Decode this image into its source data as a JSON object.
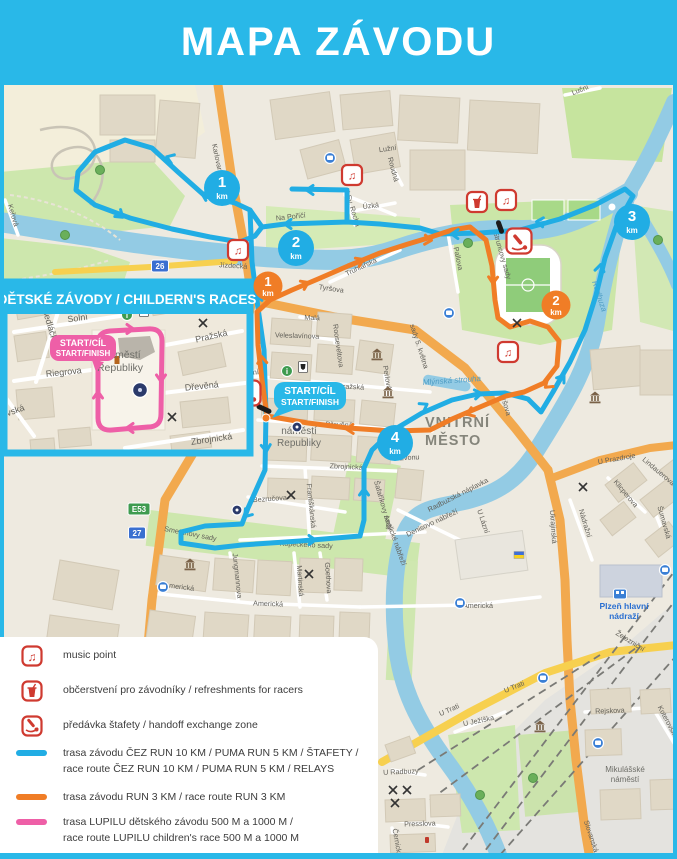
{
  "header": {
    "title": "MAPA ZÁVODU"
  },
  "colors": {
    "brand_cyan": "#29b8e8",
    "route_cyan": "#21ade4",
    "route_orange": "#f07d26",
    "route_pink": "#ee5fa7",
    "icon_red": "#cf3a30",
    "water": "#93cbe4",
    "park": "#cde7ad"
  },
  "inset": {
    "title": "DĚTSKÉ ZÁVODY / CHILDERN'S RACES",
    "start_badge": [
      "START/CÍL",
      "START/FINISH"
    ],
    "square_label": [
      "náměstí",
      "Republiky"
    ],
    "street_labels": [
      {
        "t": "Solní",
        "x": 78,
        "y": 321,
        "r": -8
      },
      {
        "t": "Pražská",
        "x": 212,
        "y": 339,
        "r": -13
      },
      {
        "t": "Sedláčkova",
        "x": 49,
        "y": 332,
        "r": 73
      },
      {
        "t": "Riegrova",
        "x": 64,
        "y": 375,
        "r": -6
      },
      {
        "t": "Dřevěná",
        "x": 202,
        "y": 389,
        "r": -6
      },
      {
        "t": "Zbrojnická",
        "x": 212,
        "y": 442,
        "r": -8
      },
      {
        "t": "ovská",
        "x": 14,
        "y": 414,
        "r": -20
      }
    ],
    "pois": [
      {
        "type": "info",
        "x": 127,
        "y": 315
      },
      {
        "type": "museum-flag",
        "x": 144,
        "y": 311
      },
      {
        "type": "monument-lg",
        "x": 140,
        "y": 390
      },
      {
        "type": "church-cross",
        "x": 203,
        "y": 323
      },
      {
        "type": "church-cross",
        "x": 172,
        "y": 417
      },
      {
        "type": "tower",
        "x": 117,
        "y": 360
      }
    ]
  },
  "map": {
    "start_badge": [
      "START/CÍL",
      "START/FINISH"
    ],
    "km_badges": [
      {
        "value": "1",
        "unit": "km",
        "variant": "cyan",
        "x": 222,
        "y": 188
      },
      {
        "value": "2",
        "unit": "km",
        "variant": "cyan",
        "x": 296,
        "y": 248
      },
      {
        "value": "3",
        "unit": "km",
        "variant": "cyan",
        "x": 632,
        "y": 222
      },
      {
        "value": "4",
        "unit": "km",
        "variant": "cyan",
        "x": 395,
        "y": 443
      },
      {
        "value": "1",
        "unit": "km",
        "variant": "orange",
        "x": 268,
        "y": 286
      },
      {
        "value": "2",
        "unit": "km",
        "variant": "orange",
        "x": 556,
        "y": 305
      }
    ],
    "road_badges": [
      {
        "t": "26",
        "x": 160,
        "y": 266,
        "variant": "blue"
      },
      {
        "t": "27",
        "x": 137,
        "y": 533,
        "variant": "blue"
      },
      {
        "t": "E53",
        "x": 139,
        "y": 509,
        "variant": "green"
      }
    ],
    "street_labels": [
      {
        "t": "Karlovarská",
        "x": 216,
        "y": 163,
        "r": 78
      },
      {
        "t": "Jízdecká",
        "x": 233,
        "y": 268,
        "r": 3
      },
      {
        "t": "Na Poříčí",
        "x": 291,
        "y": 219,
        "r": -6
      },
      {
        "t": "Tyršova",
        "x": 331,
        "y": 291,
        "r": 8
      },
      {
        "t": "Tyršova",
        "x": 503,
        "y": 404,
        "r": 73
      },
      {
        "t": "sady 5. května",
        "x": 417,
        "y": 347,
        "r": 72
      },
      {
        "t": "Rooseveltova",
        "x": 336,
        "y": 346,
        "r": 82
      },
      {
        "t": "Pražská",
        "x": 351,
        "y": 389,
        "r": 3
      },
      {
        "t": "Dřevěná",
        "x": 339,
        "y": 427,
        "r": 2
      },
      {
        "t": "Zbrojnická",
        "x": 346,
        "y": 469,
        "r": 3
      },
      {
        "t": "Bezručova",
        "x": 270,
        "y": 501,
        "r": -4
      },
      {
        "t": "Františkánská",
        "x": 309,
        "y": 506,
        "r": 84
      },
      {
        "t": "Smetanovy sady",
        "x": 190,
        "y": 536,
        "r": 11
      },
      {
        "t": "Kopeckého sady",
        "x": 306,
        "y": 547,
        "r": 3
      },
      {
        "t": "Americká",
        "x": 179,
        "y": 589,
        "r": 7
      },
      {
        "t": "Americká",
        "x": 268,
        "y": 606,
        "r": 2
      },
      {
        "t": "Americká",
        "x": 478,
        "y": 608,
        "r": 0
      },
      {
        "t": "Jungmannova",
        "x": 235,
        "y": 576,
        "r": 84
      },
      {
        "t": "Martinská",
        "x": 298,
        "y": 581,
        "r": 86
      },
      {
        "t": "Goethova",
        "x": 326,
        "y": 578,
        "r": 86
      },
      {
        "t": "Šafaříkovy sady",
        "x": 381,
        "y": 506,
        "r": 74
      },
      {
        "t": "Anglické nábřeží",
        "x": 393,
        "y": 541,
        "r": 70
      },
      {
        "t": "Pallova",
        "x": 456,
        "y": 259,
        "r": 78
      },
      {
        "t": "Štruncovy sady",
        "x": 500,
        "y": 256,
        "r": 74
      },
      {
        "t": "U Zvonu",
        "x": 406,
        "y": 460,
        "r": -3
      },
      {
        "t": "Denisovo nábřeží",
        "x": 433,
        "y": 525,
        "r": -25
      },
      {
        "t": "Radbuzská náplavka",
        "x": 459,
        "y": 497,
        "r": -27
      },
      {
        "t": "U Lázní",
        "x": 481,
        "y": 522,
        "r": 72
      },
      {
        "t": "Ukrajinská",
        "x": 551,
        "y": 527,
        "r": 86
      },
      {
        "t": "Nádražní",
        "x": 583,
        "y": 524,
        "r": 73
      },
      {
        "t": "U Prazdroje",
        "x": 617,
        "y": 461,
        "r": -10
      },
      {
        "t": "Šumavská",
        "x": 662,
        "y": 523,
        "r": 74
      },
      {
        "t": "Železniční",
        "x": 629,
        "y": 643,
        "r": 32
      },
      {
        "t": "U Trati",
        "x": 450,
        "y": 712,
        "r": -24
      },
      {
        "t": "U Trati",
        "x": 515,
        "y": 689,
        "r": -22
      },
      {
        "t": "U Ježíška",
        "x": 479,
        "y": 723,
        "r": -12
      },
      {
        "t": "U Radbuzy",
        "x": 401,
        "y": 774,
        "r": -3
      },
      {
        "t": "Presslova",
        "x": 420,
        "y": 826,
        "r": -2
      },
      {
        "t": "Černická",
        "x": 395,
        "y": 843,
        "r": 80
      },
      {
        "t": "Rejskova",
        "x": 610,
        "y": 713,
        "r": -2
      },
      {
        "t": "Koterovská",
        "x": 666,
        "y": 723,
        "r": 62
      },
      {
        "t": "Slovanská",
        "x": 589,
        "y": 837,
        "r": 72
      },
      {
        "t": "Solní",
        "x": 251,
        "y": 375,
        "r": -8
      },
      {
        "t": "Luční",
        "x": 581,
        "y": 92,
        "r": -22
      },
      {
        "t": "Úzká",
        "x": 371,
        "y": 208,
        "r": -6
      },
      {
        "t": "Roudná",
        "x": 391,
        "y": 170,
        "r": 75
      },
      {
        "t": "Lužní",
        "x": 388,
        "y": 151,
        "r": -8
      },
      {
        "t": "U Sv. Rocha",
        "x": 350,
        "y": 208,
        "r": 73
      },
      {
        "t": "Veleslavínova",
        "x": 297,
        "y": 338,
        "r": 2
      },
      {
        "t": "Malá",
        "x": 312,
        "y": 320,
        "r": 2
      },
      {
        "t": "Truhlářská",
        "x": 362,
        "y": 269,
        "r": -25
      },
      {
        "t": "Perlová",
        "x": 385,
        "y": 378,
        "r": 80
      },
      {
        "t": "Keřová",
        "x": 11,
        "y": 216,
        "r": 73
      },
      {
        "t": "Klicperova",
        "x": 624,
        "y": 495,
        "r": 50
      },
      {
        "t": "Lindauerova",
        "x": 657,
        "y": 473,
        "r": 40
      }
    ],
    "place_labels": [
      {
        "lines": [
          "VNITŘNÍ",
          "MĚSTO"
        ],
        "x": 425,
        "y": 427,
        "size": 14.5,
        "color": "#85857b",
        "weight": "bold",
        "anchor": "start",
        "lh": 18,
        "spacing": 1
      },
      {
        "lines": [
          "náměstí",
          "Republiky"
        ],
        "x": 299,
        "y": 434,
        "size": 10,
        "color": "#6e6e68",
        "weight": "normal",
        "anchor": "middle",
        "lh": 12,
        "spacing": 0
      },
      {
        "lines": [
          "Plzeň hlavní",
          "nádraží"
        ],
        "x": 624,
        "y": 609,
        "size": 8.5,
        "color": "#2a6fd1",
        "weight": "bold",
        "anchor": "middle",
        "lh": 10,
        "spacing": 0
      },
      {
        "lines": [
          "Mikulášské",
          "náměstí"
        ],
        "x": 625,
        "y": 772,
        "size": 8,
        "color": "#6e6e68",
        "weight": "normal",
        "anchor": "middle",
        "lh": 10,
        "spacing": 0
      }
    ],
    "water_labels": [
      {
        "t": "Radbuza",
        "x": 597,
        "y": 297,
        "r": 72
      },
      {
        "t": "Mlýnská strouha",
        "x": 452,
        "y": 383,
        "r": -4
      }
    ],
    "pois": [
      {
        "type": "music",
        "x": 238,
        "y": 250
      },
      {
        "type": "music",
        "x": 352,
        "y": 175
      },
      {
        "type": "music",
        "x": 506,
        "y": 200
      },
      {
        "type": "music",
        "x": 508,
        "y": 352
      },
      {
        "type": "refreshment",
        "x": 477,
        "y": 202
      },
      {
        "type": "handoff",
        "x": 519,
        "y": 241
      },
      {
        "type": "handoff",
        "x": 248,
        "y": 393
      },
      {
        "type": "info",
        "x": 287,
        "y": 371
      },
      {
        "type": "museum-flag",
        "x": 303,
        "y": 367
      },
      {
        "type": "monument",
        "x": 297,
        "y": 427
      },
      {
        "type": "monument",
        "x": 237,
        "y": 510
      },
      {
        "type": "church-cross",
        "x": 291,
        "y": 495
      },
      {
        "type": "church-cross",
        "x": 309,
        "y": 574
      },
      {
        "type": "church-cross",
        "x": 517,
        "y": 323
      },
      {
        "type": "church-cross",
        "x": 583,
        "y": 487
      },
      {
        "type": "church-cross",
        "x": 393,
        "y": 790
      },
      {
        "type": "church-cross",
        "x": 407,
        "y": 790
      },
      {
        "type": "church-cross",
        "x": 395,
        "y": 803
      },
      {
        "type": "museum",
        "x": 377,
        "y": 355
      },
      {
        "type": "museum",
        "x": 388,
        "y": 393
      },
      {
        "type": "museum",
        "x": 190,
        "y": 565
      },
      {
        "type": "museum",
        "x": 595,
        "y": 398
      },
      {
        "type": "museum",
        "x": 540,
        "y": 727
      },
      {
        "type": "bus",
        "x": 330,
        "y": 158
      },
      {
        "type": "bus",
        "x": 449,
        "y": 313
      },
      {
        "type": "bus",
        "x": 460,
        "y": 603
      },
      {
        "type": "bus",
        "x": 543,
        "y": 678
      },
      {
        "type": "bus",
        "x": 598,
        "y": 743
      },
      {
        "type": "bus",
        "x": 163,
        "y": 587
      },
      {
        "type": "bus",
        "x": 665,
        "y": 570
      },
      {
        "type": "train",
        "x": 620,
        "y": 594
      },
      {
        "type": "flag-ua",
        "x": 519,
        "y": 555
      },
      {
        "type": "hydrant",
        "x": 427,
        "y": 840
      },
      {
        "type": "tree",
        "x": 533,
        "y": 778
      },
      {
        "type": "tree",
        "x": 100,
        "y": 170
      },
      {
        "type": "tree",
        "x": 65,
        "y": 235
      },
      {
        "type": "tree",
        "x": 468,
        "y": 243
      },
      {
        "type": "tree",
        "x": 658,
        "y": 240
      },
      {
        "type": "tree",
        "x": 480,
        "y": 795
      }
    ]
  },
  "legend": {
    "items": [
      {
        "icon": "music",
        "label_lines": [
          "music point"
        ]
      },
      {
        "icon": "refreshment",
        "label_lines": [
          "občerstvení pro závodníky / refreshments for racers"
        ]
      },
      {
        "icon": "handoff",
        "label_lines": [
          "předávka štafety / handoff exchange zone"
        ]
      },
      {
        "swatch": "#21ade4",
        "label_lines": [
          "trasa závodu ČEZ RUN 10 KM / PUMA RUN 5 KM / ŠTAFETY /",
          "race route ČEZ RUN 10 KM / PUMA RUN 5 KM / RELAYS"
        ]
      },
      {
        "swatch": "#f07d26",
        "label_lines": [
          "trasa závodu RUN 3 KM / race route RUN 3 KM"
        ]
      },
      {
        "swatch": "#ee5fa7",
        "label_lines": [
          "trasa LUPILU dětského závodu 500 M a 1000 M /",
          "race route LUPILU children's race 500 M a 1000 M"
        ]
      }
    ]
  }
}
